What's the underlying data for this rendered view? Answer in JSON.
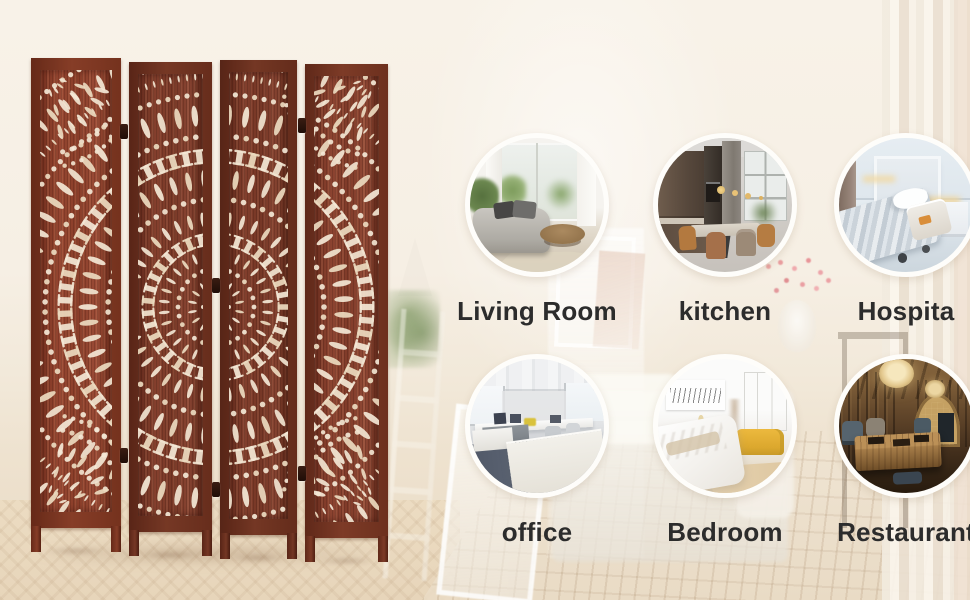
{
  "banner": {
    "rooms": [
      {
        "label": "Living Room"
      },
      {
        "label": "kitchen"
      },
      {
        "label": "Hospita"
      },
      {
        "label": "office"
      },
      {
        "label": "Bedroom"
      },
      {
        "label": "Restaurant"
      }
    ],
    "colors": {
      "background": "#f5eee3",
      "wood": "#7d3a29",
      "wood_frame": "#5e2a1c",
      "cutout": "#f0e3cf",
      "label_text": "#2c2c2c",
      "circle_ring": "#fefdfa"
    }
  }
}
